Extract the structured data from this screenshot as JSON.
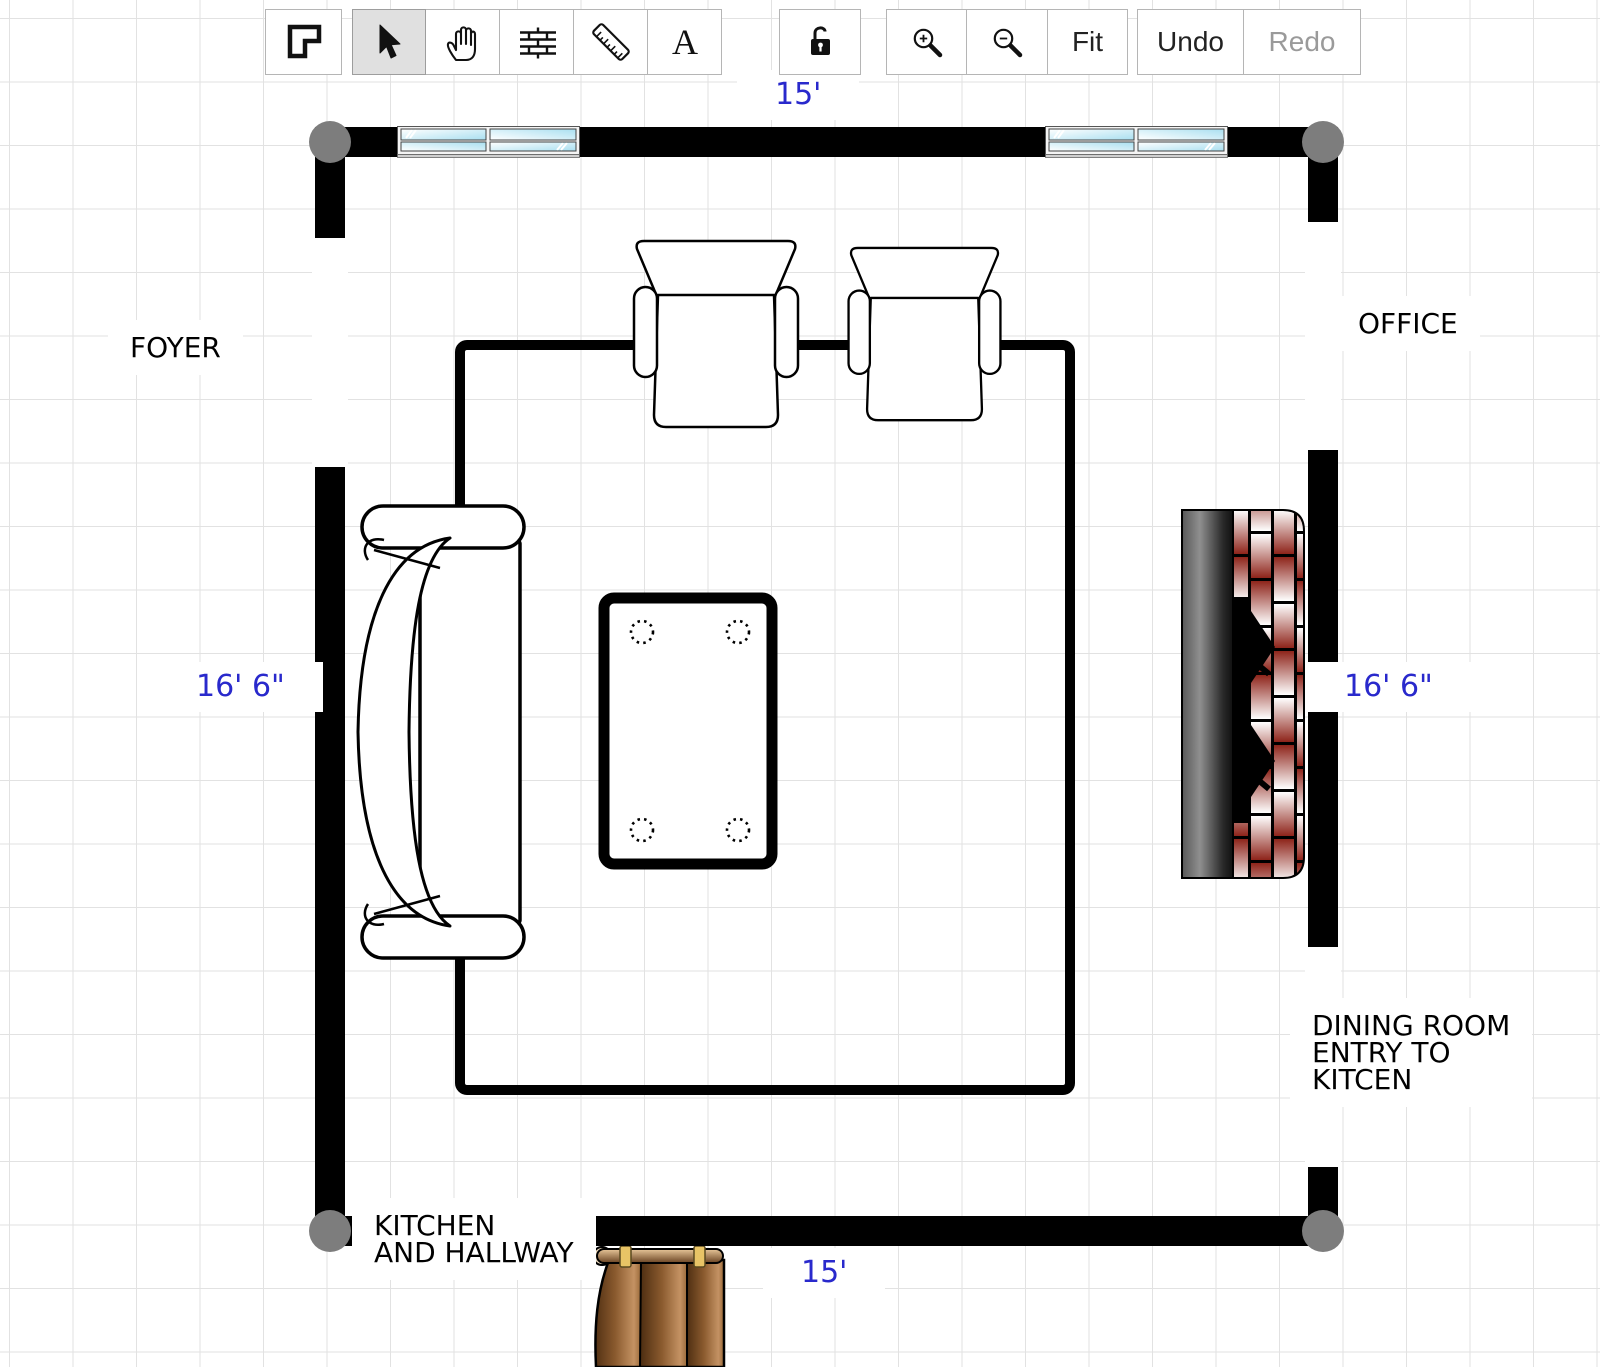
{
  "toolbar": {
    "tools": [
      {
        "name": "room-shape"
      },
      {
        "name": "select",
        "selected": true
      },
      {
        "name": "pan"
      },
      {
        "name": "walls"
      },
      {
        "name": "measure"
      },
      {
        "name": "text",
        "glyph": "A"
      },
      {
        "name": "lock"
      },
      {
        "name": "zoom-in"
      },
      {
        "name": "zoom-out"
      },
      {
        "name": "fit",
        "label": "Fit"
      },
      {
        "name": "undo",
        "label": "Undo"
      },
      {
        "name": "redo",
        "label": "Redo",
        "disabled": true
      }
    ]
  },
  "labels": {
    "foyer": "FOYER",
    "office": "OFFICE",
    "dining_line1": "DINING ROOM",
    "dining_line2": "ENTRY TO",
    "dining_line3": "KITCEN",
    "kitchen_line1": "KITCHEN",
    "kitchen_line2": "AND HALLWAY"
  },
  "dimensions": {
    "top": "15'",
    "bottom": "15'",
    "left": "16' 6\"",
    "right": "16' 6\""
  },
  "furniture": [
    "window",
    "window",
    "armchair",
    "armchair",
    "sofa",
    "coffee-table",
    "fireplace",
    "wood-cabinet"
  ],
  "colors": {
    "wall": "#000000",
    "joint": "#7d7d7d",
    "dimension_text": "#2929cc",
    "label_text": "#000000",
    "grid_line": "#e2e2e2",
    "window_pane": "#b9e5f3",
    "brick": "#9a2b1d",
    "hearth_dark": "#1c1c1c",
    "wood_dark": "#5c3a1a",
    "wood_light": "#c49263",
    "handle_gold": "#e8c466",
    "toolbar_selected_bg": "#e0e0e0",
    "disabled_text": "#9a9a9a"
  }
}
